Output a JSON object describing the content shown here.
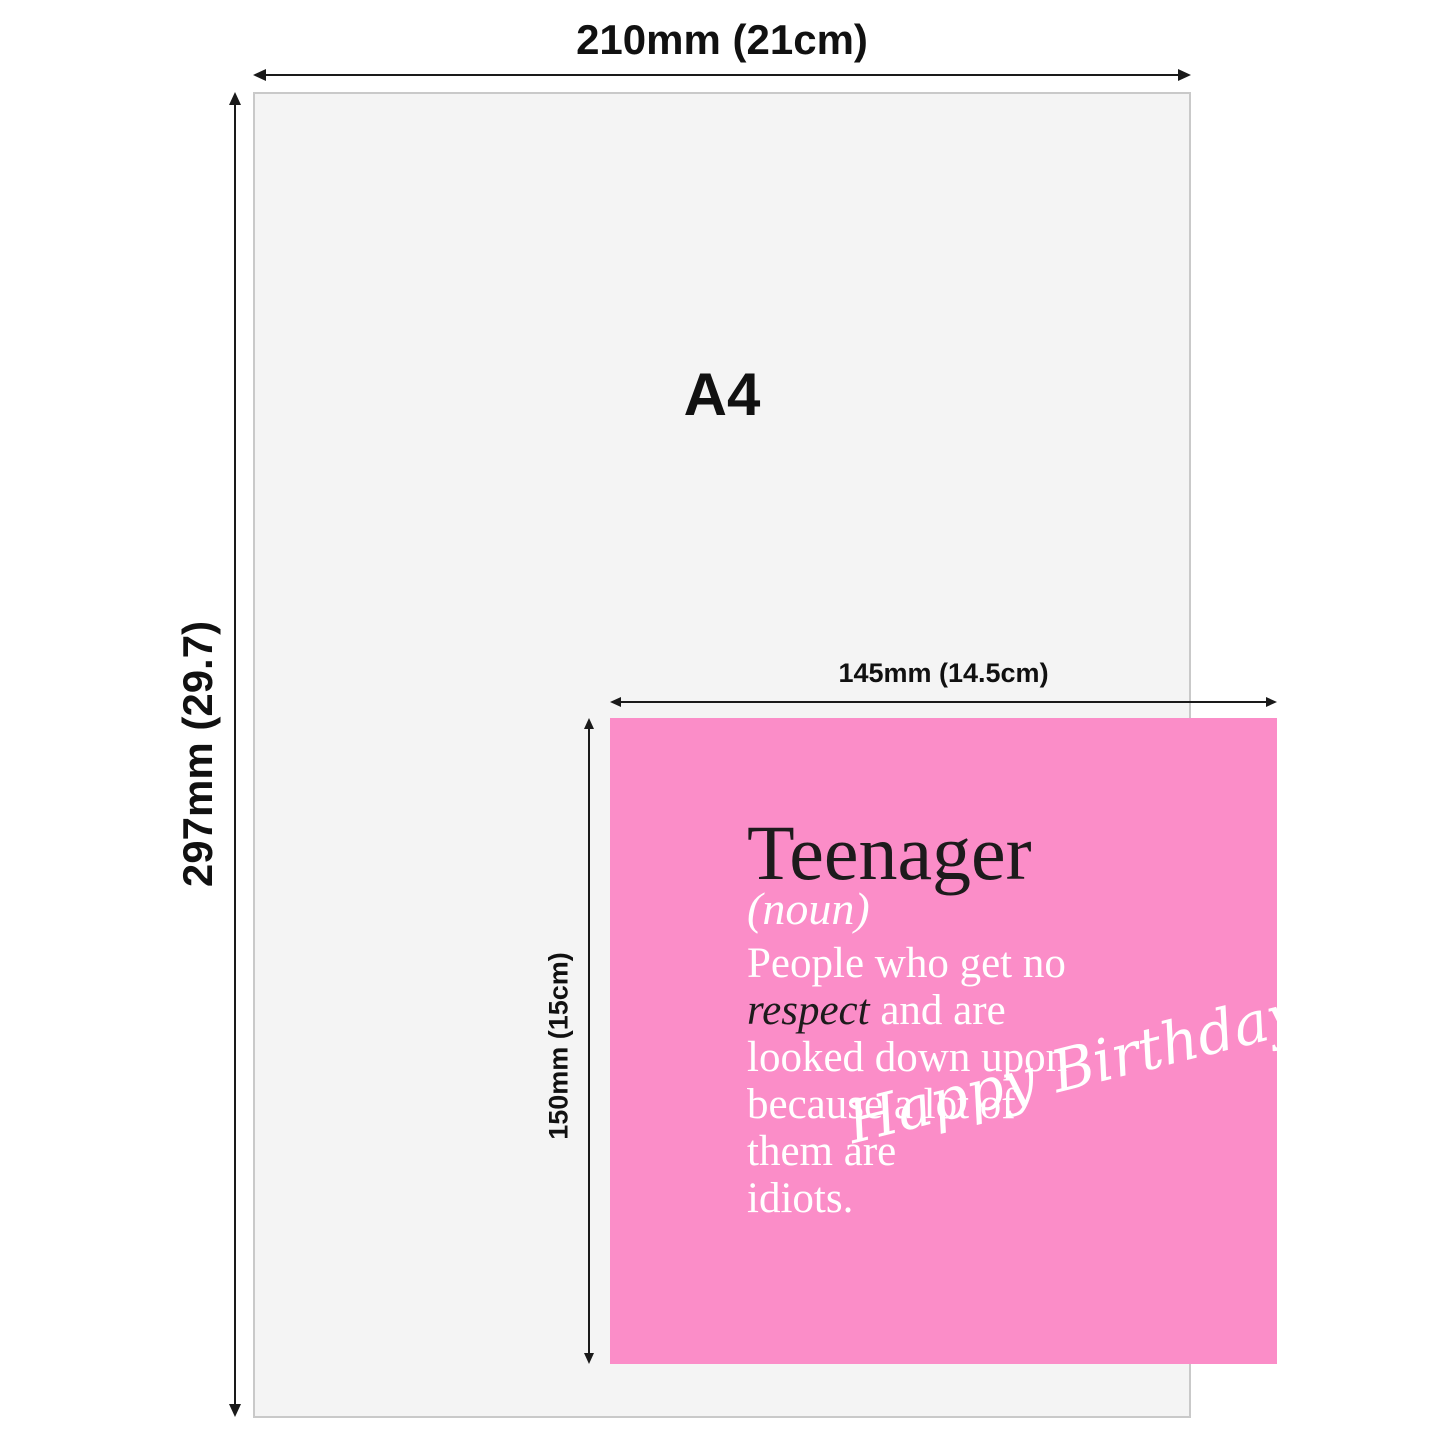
{
  "diagram": {
    "a4": {
      "label": "A4",
      "width_label": "210mm (21cm)",
      "height_label": "297mm (29.7)"
    },
    "card": {
      "width_label": "145mm (14.5cm)",
      "height_label": "150mm (15cm)",
      "title": "Teenager",
      "subtitle": "(noun)",
      "body": {
        "line1": "People who get no",
        "line2_emphasis": "respect",
        "line2_rest": " and are",
        "line3": "looked down upon",
        "line4": "because a lot of",
        "line5": "them are",
        "line6": "idiots."
      },
      "script_text": "Happy Birthday"
    },
    "colors": {
      "paper_fill": "#f4f4f4",
      "paper_border": "#c9c9c9",
      "card_pink": "#fb8dc8",
      "ink": "#1a1a1a",
      "card_dark_text": "#1d1b1c",
      "card_light_text": "#ffffff"
    }
  }
}
